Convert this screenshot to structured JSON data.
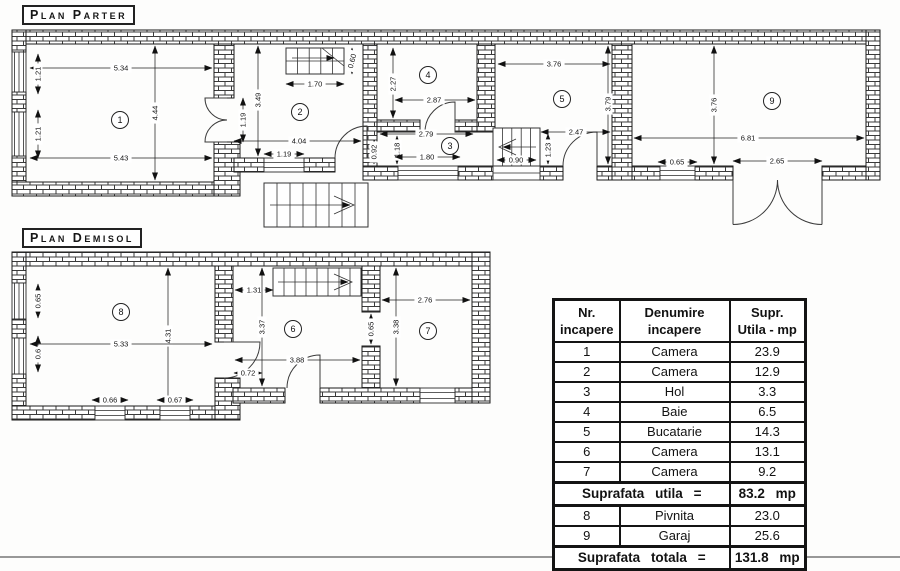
{
  "titles": {
    "parter": "Plan Parter",
    "demisol": "Plan Demisol"
  },
  "parter": {
    "rooms": [
      {
        "n": "1",
        "x": 120,
        "y": 120
      },
      {
        "n": "2",
        "x": 300,
        "y": 112
      },
      {
        "n": "3",
        "x": 450,
        "y": 146
      },
      {
        "n": "4",
        "x": 428,
        "y": 75
      },
      {
        "n": "5",
        "x": 562,
        "y": 99
      },
      {
        "n": "9",
        "x": 772,
        "y": 101
      }
    ],
    "dims": [
      {
        "v": "5.34",
        "x1": 30,
        "y1": 68,
        "x2": 212,
        "y2": 68,
        "lx": 121,
        "ly": 68,
        "rot": 0
      },
      {
        "v": "1.21",
        "x1": 38,
        "y1": 54,
        "x2": 38,
        "y2": 94,
        "lx": 38,
        "ly": 74,
        "rot": -90
      },
      {
        "v": "4.44",
        "x1": 155,
        "y1": 46,
        "x2": 155,
        "y2": 180,
        "lx": 155,
        "ly": 113,
        "rot": -90
      },
      {
        "v": "1.21",
        "x1": 38,
        "y1": 110,
        "x2": 38,
        "y2": 158,
        "lx": 38,
        "ly": 134,
        "rot": -90
      },
      {
        "v": "5.43",
        "x1": 30,
        "y1": 158,
        "x2": 212,
        "y2": 158,
        "lx": 121,
        "ly": 158,
        "rot": 0
      },
      {
        "v": "1.19",
        "x1": 243,
        "y1": 98,
        "x2": 243,
        "y2": 142,
        "lx": 243,
        "ly": 120,
        "rot": -90
      },
      {
        "v": "3.49",
        "x1": 258,
        "y1": 46,
        "x2": 258,
        "y2": 156,
        "lx": 258,
        "ly": 100,
        "rot": -90
      },
      {
        "v": "1.70",
        "x1": 286,
        "y1": 84,
        "x2": 344,
        "y2": 84,
        "lx": 315,
        "ly": 84,
        "rot": 0
      },
      {
        "v": "0.60",
        "x1": 352,
        "y1": 48,
        "x2": 352,
        "y2": 74,
        "lx": 352,
        "ly": 61,
        "rot": -75
      },
      {
        "v": "4.04",
        "x1": 234,
        "y1": 141,
        "x2": 361,
        "y2": 141,
        "lx": 299,
        "ly": 141,
        "rot": 0
      },
      {
        "v": "1.19",
        "x1": 264,
        "y1": 154,
        "x2": 304,
        "y2": 154,
        "lx": 284,
        "ly": 154,
        "rot": 0
      },
      {
        "v": "0.92",
        "x1": 374,
        "y1": 140,
        "x2": 374,
        "y2": 164,
        "lx": 374,
        "ly": 152,
        "rot": -90
      },
      {
        "v": "1.18",
        "x1": 397,
        "y1": 136,
        "x2": 397,
        "y2": 164,
        "lx": 397,
        "ly": 150,
        "rot": -90
      },
      {
        "v": "2.79",
        "x1": 380,
        "y1": 134,
        "x2": 473,
        "y2": 134,
        "lx": 426,
        "ly": 134,
        "rot": 0
      },
      {
        "v": "1.80",
        "x1": 395,
        "y1": 157,
        "x2": 460,
        "y2": 157,
        "lx": 427,
        "ly": 157,
        "rot": 0
      },
      {
        "v": "2.27",
        "x1": 393,
        "y1": 48,
        "x2": 393,
        "y2": 118,
        "lx": 393,
        "ly": 84,
        "rot": -90
      },
      {
        "v": "2.87",
        "x1": 395,
        "y1": 100,
        "x2": 475,
        "y2": 100,
        "lx": 434,
        "ly": 100,
        "rot": 0
      },
      {
        "v": "3.76",
        "x1": 498,
        "y1": 64,
        "x2": 610,
        "y2": 64,
        "lx": 554,
        "ly": 64,
        "rot": 0
      },
      {
        "v": "3.79",
        "x1": 608,
        "y1": 46,
        "x2": 608,
        "y2": 164,
        "lx": 608,
        "ly": 104,
        "rot": -90
      },
      {
        "v": "2.47",
        "x1": 541,
        "y1": 132,
        "x2": 610,
        "y2": 132,
        "lx": 576,
        "ly": 132,
        "rot": 0
      },
      {
        "v": "1.23",
        "x1": 548,
        "y1": 134,
        "x2": 548,
        "y2": 164,
        "lx": 548,
        "ly": 150,
        "rot": -90
      },
      {
        "v": "0.90",
        "x1": 497,
        "y1": 160,
        "x2": 536,
        "y2": 160,
        "lx": 516,
        "ly": 160,
        "rot": 0
      },
      {
        "v": "3.76",
        "x1": 714,
        "y1": 46,
        "x2": 714,
        "y2": 164,
        "lx": 714,
        "ly": 105,
        "rot": -90
      },
      {
        "v": "6.81",
        "x1": 634,
        "y1": 138,
        "x2": 864,
        "y2": 138,
        "lx": 748,
        "ly": 138,
        "rot": 0
      },
      {
        "v": "0.65",
        "x1": 658,
        "y1": 162,
        "x2": 697,
        "y2": 162,
        "lx": 677,
        "ly": 162,
        "rot": 0
      },
      {
        "v": "2.65",
        "x1": 733,
        "y1": 161,
        "x2": 822,
        "y2": 161,
        "lx": 777,
        "ly": 161,
        "rot": 0
      }
    ]
  },
  "demisol": {
    "rooms": [
      {
        "n": "8",
        "x": 121,
        "y": 312
      },
      {
        "n": "6",
        "x": 293,
        "y": 329
      },
      {
        "n": "7",
        "x": 428,
        "y": 331
      }
    ],
    "dims": [
      {
        "v": "0.65",
        "x1": 38,
        "y1": 284,
        "x2": 38,
        "y2": 318,
        "lx": 38,
        "ly": 301,
        "rot": -90
      },
      {
        "v": "0.6",
        "x1": 38,
        "y1": 336,
        "x2": 38,
        "y2": 372,
        "lx": 38,
        "ly": 354,
        "rot": -90
      },
      {
        "v": "4.31",
        "x1": 168,
        "y1": 268,
        "x2": 168,
        "y2": 404,
        "lx": 168,
        "ly": 336,
        "rot": -90
      },
      {
        "v": "5.33",
        "x1": 30,
        "y1": 344,
        "x2": 212,
        "y2": 344,
        "lx": 121,
        "ly": 344,
        "rot": 0
      },
      {
        "v": "0.66",
        "x1": 92,
        "y1": 400,
        "x2": 128,
        "y2": 400,
        "lx": 110,
        "ly": 400,
        "rot": 0
      },
      {
        "v": "0.67",
        "x1": 157,
        "y1": 400,
        "x2": 193,
        "y2": 400,
        "lx": 175,
        "ly": 400,
        "rot": 0
      },
      {
        "v": "1.31",
        "x1": 235,
        "y1": 290,
        "x2": 273,
        "y2": 290,
        "lx": 254,
        "ly": 290,
        "rot": 0
      },
      {
        "v": "3.37",
        "x1": 262,
        "y1": 268,
        "x2": 262,
        "y2": 386,
        "lx": 262,
        "ly": 327,
        "rot": -90
      },
      {
        "v": "3.88",
        "x1": 235,
        "y1": 360,
        "x2": 360,
        "y2": 360,
        "lx": 297,
        "ly": 360,
        "rot": 0
      },
      {
        "v": "0.72",
        "x1": 234,
        "y1": 373,
        "x2": 262,
        "y2": 373,
        "lx": 248,
        "ly": 373,
        "rot": 0
      },
      {
        "v": "0.65",
        "x1": 371,
        "y1": 314,
        "x2": 371,
        "y2": 344,
        "lx": 371,
        "ly": 329,
        "rot": -90
      },
      {
        "v": "2.76",
        "x1": 382,
        "y1": 300,
        "x2": 470,
        "y2": 300,
        "lx": 425,
        "ly": 300,
        "rot": 0
      },
      {
        "v": "3.38",
        "x1": 396,
        "y1": 268,
        "x2": 396,
        "y2": 386,
        "lx": 396,
        "ly": 327,
        "rot": -90
      }
    ]
  },
  "table": {
    "col1": {
      "line1": "Nr.",
      "line2": "incapere"
    },
    "col2": {
      "line1": "Denumire",
      "line2": "incapere"
    },
    "col3": {
      "line1": "Supr.",
      "line2": "Utila - mp"
    },
    "rows": [
      {
        "nr": "1",
        "name": "Camera",
        "area": "23.9"
      },
      {
        "nr": "2",
        "name": "Camera",
        "area": "12.9"
      },
      {
        "nr": "3",
        "name": "Hol",
        "area": "3.3"
      },
      {
        "nr": "4",
        "name": "Baie",
        "area": "6.5"
      },
      {
        "nr": "5",
        "name": "Bucatarie",
        "area": "14.3"
      },
      {
        "nr": "6",
        "name": "Camera",
        "area": "13.1"
      },
      {
        "nr": "7",
        "name": "Camera",
        "area": "9.2"
      }
    ],
    "subtotal": {
      "label": "Suprafata utila =",
      "value": "83.2",
      "unit": "mp"
    },
    "rows2": [
      {
        "nr": "8",
        "name": "Pivnita",
        "area": "23.0"
      },
      {
        "nr": "9",
        "name": "Garaj",
        "area": "25.6"
      }
    ],
    "total": {
      "label": "Suprafata totala =",
      "value": "131.8",
      "unit": "mp"
    }
  }
}
